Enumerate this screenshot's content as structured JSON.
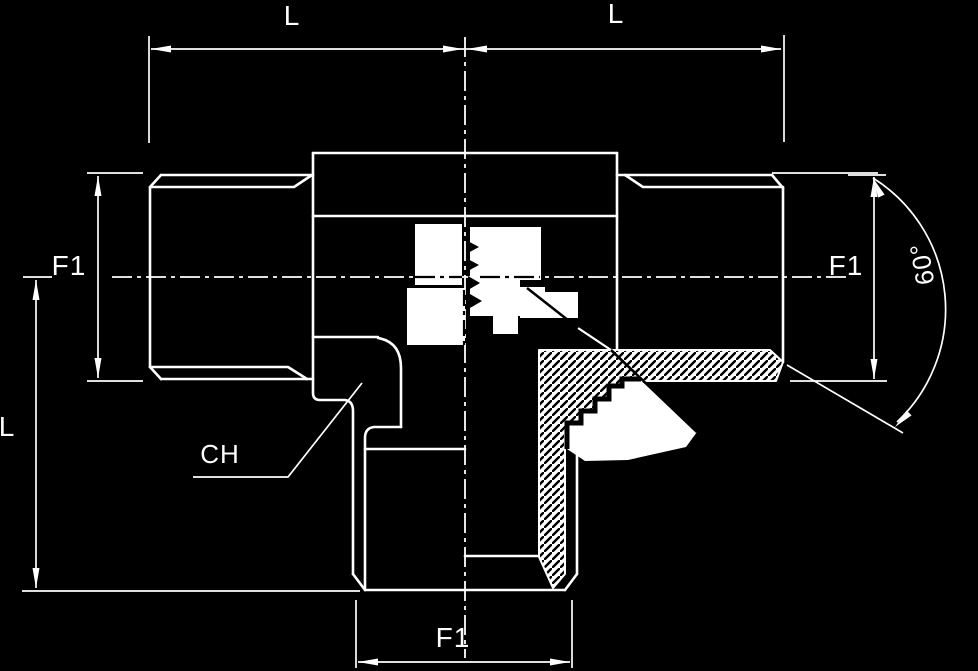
{
  "drawing": {
    "title": "tee-fitting-technical-drawing",
    "labels": {
      "dim_top_left": "L",
      "dim_top_right": "L",
      "dim_left_thread": "F1",
      "dim_right_thread": "F1",
      "dim_bottom_thread": "F1",
      "dim_height": "L",
      "label_chamfer": "CH",
      "label_angle": "60°"
    },
    "colors": {
      "background": "#000000",
      "line": "#ffffff",
      "hatch_fill": "#ffffff",
      "hatch_line": "#000000",
      "patch_fill": "#ffffff"
    }
  }
}
